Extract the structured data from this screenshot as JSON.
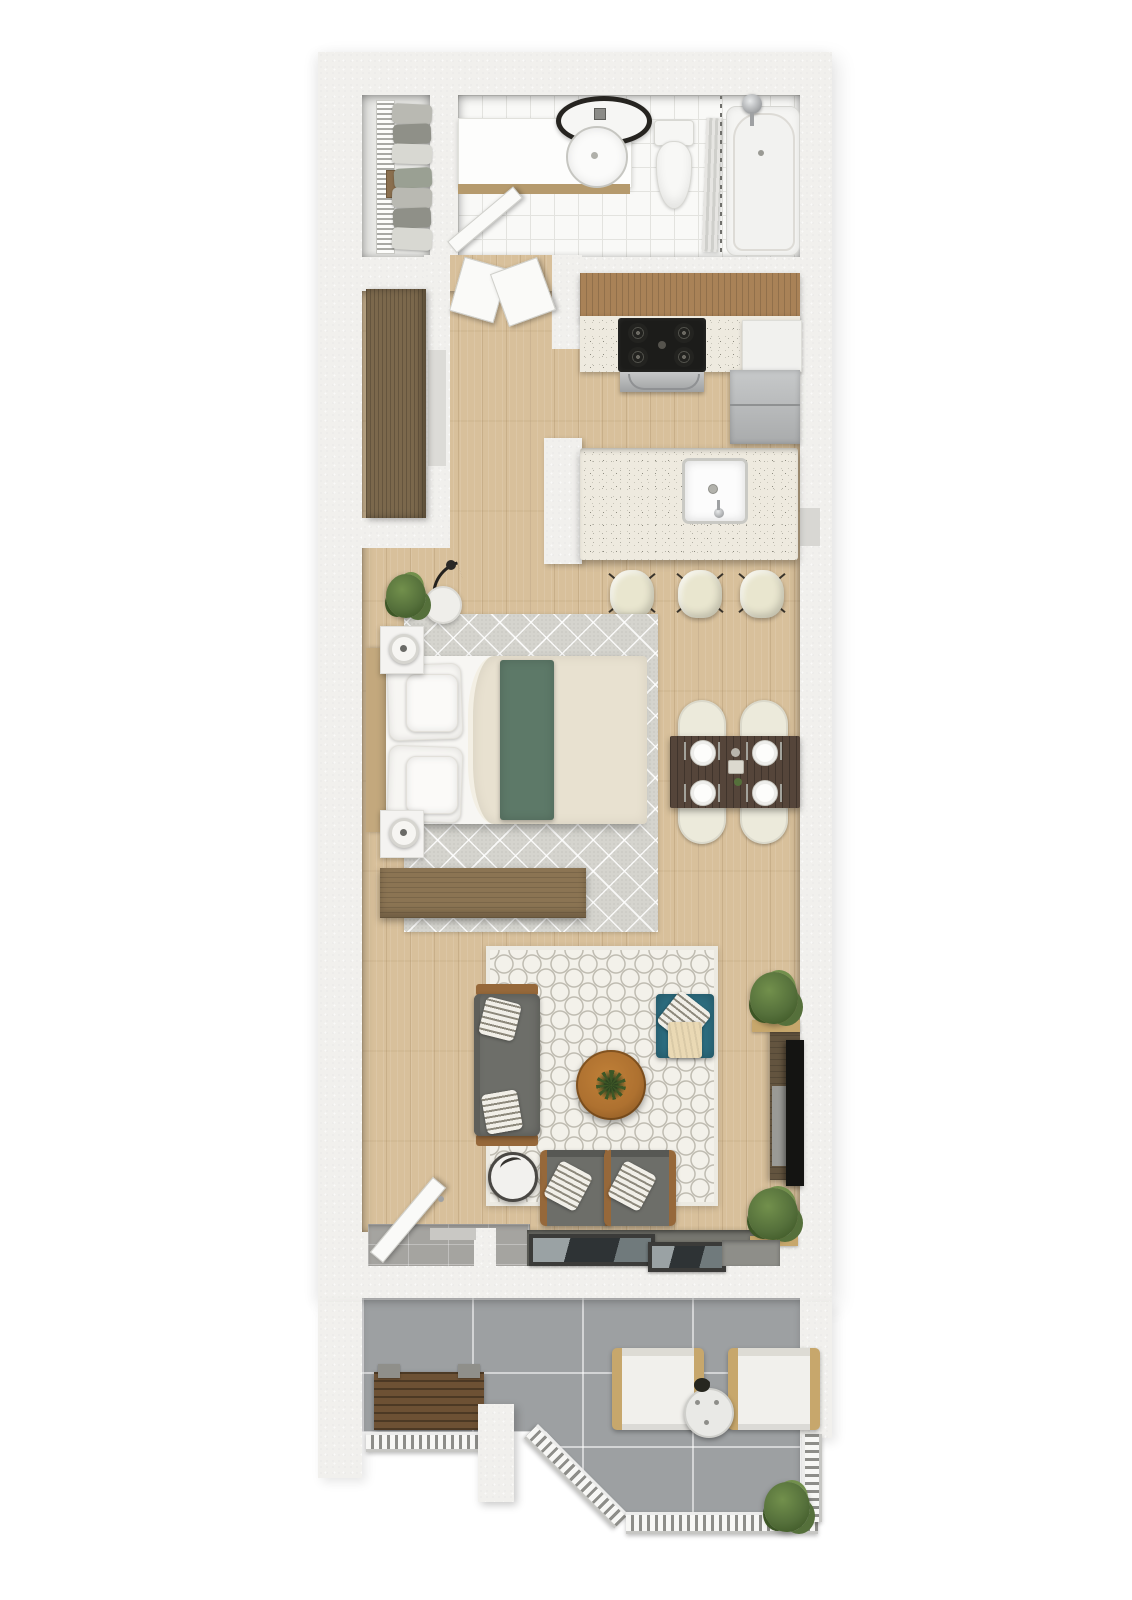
{
  "scene": {
    "type": "3d-floor-plan-render",
    "view": "top-down",
    "description": "Photorealistic top-down 3D rendering of a narrow studio apartment floor plan with closet, bathroom, galley kitchen with island, sleeping area, dining area, living area, tiled entry with sliding glass doors and a lower balcony with railing"
  },
  "palette": {
    "wall": "#f1f0ed",
    "wall_shade": "#d8d7d3",
    "wood_floor": "#d8c09b",
    "wood_line": "#c2a67d",
    "tile_white": "#f9f9f7",
    "tile_line": "#e3e3df",
    "closet_floor": "#e8e8e5",
    "entry_tile": "#a5a4a0",
    "balcony_tile": "#9da0a2",
    "cabinet_wood": "#a98257",
    "counter_base": "#eeeadf",
    "stove": "#1c1c1a",
    "stainless": "#b8babb",
    "wardrobe": "#7b684c",
    "walnut": "#55453a",
    "cream_chair": "#eceadb",
    "stool_cream": "#e9e6cf",
    "rug_gray": "#d5d4ce",
    "rug_white": "#f3f1ea",
    "bed_white": "#f7f6f3",
    "blanket": "#e8e1d0",
    "green": "#5d7968",
    "headboard": "#c3a87d",
    "dresser": "#8b7453",
    "sofa": "#6d6e69",
    "wood_accent": "#96683a",
    "teal": "#2d6e81",
    "table_wood": "#ae7130",
    "console": "#63543f",
    "tv": "#141412",
    "plant": "#55703b",
    "plant_light": "#72904c",
    "plant_dark": "#3d5726",
    "railing_dark": "#8d8d89",
    "bench": "#6d5134",
    "arm_wood": "#c7a76c",
    "door_white": "#fafaf8",
    "frame_dark": "#3b3b39",
    "glass": "#2e3335",
    "stripe_dark": "#8d897c",
    "stripe_light": "#f1efe8",
    "throw_cream": "#ead9b4"
  },
  "rooms": {
    "closet": {
      "name": "walk-in-closet",
      "items": [
        {
          "name": "hanging-clothes-rack"
        },
        {
          "name": "shelf-box"
        }
      ]
    },
    "bathroom": {
      "name": "bathroom",
      "items": [
        {
          "name": "vanity-counter"
        },
        {
          "name": "mirror-vanity-light"
        },
        {
          "name": "round-basin"
        },
        {
          "name": "toilet"
        },
        {
          "name": "shower-curtain"
        },
        {
          "name": "bathtub"
        },
        {
          "name": "bathroom-door"
        }
      ]
    },
    "hall": {
      "name": "entry-hall",
      "items": [
        {
          "name": "wardrobe-cabinet"
        },
        {
          "name": "hall-door-ajar"
        }
      ]
    },
    "kitchen": {
      "name": "kitchen",
      "items": [
        {
          "name": "upper-cabinets"
        },
        {
          "name": "counter"
        },
        {
          "name": "gas-cooktop"
        },
        {
          "name": "oven"
        },
        {
          "name": "refrigerator"
        },
        {
          "name": "kitchen-island"
        },
        {
          "name": "island-sink"
        },
        {
          "name": "bar-stool"
        },
        {
          "name": "bar-stool"
        },
        {
          "name": "bar-stool"
        }
      ]
    },
    "bedroom": {
      "name": "sleeping-area",
      "items": [
        {
          "name": "area-rug"
        },
        {
          "name": "queen-bed"
        },
        {
          "name": "headboard"
        },
        {
          "name": "duvet"
        },
        {
          "name": "green-throw"
        },
        {
          "name": "pillows"
        },
        {
          "name": "nightstand"
        },
        {
          "name": "nightstand"
        },
        {
          "name": "floor-lamp"
        },
        {
          "name": "potted-plant"
        },
        {
          "name": "dresser"
        }
      ]
    },
    "dining": {
      "name": "dining-area",
      "items": [
        {
          "name": "dining-table"
        },
        {
          "name": "dining-chair"
        },
        {
          "name": "dining-chair"
        },
        {
          "name": "dining-chair"
        },
        {
          "name": "dining-chair"
        },
        {
          "name": "place-setting"
        },
        {
          "name": "centerpiece"
        }
      ]
    },
    "living": {
      "name": "living-area",
      "items": [
        {
          "name": "area-rug"
        },
        {
          "name": "sofa"
        },
        {
          "name": "throw-pillow"
        },
        {
          "name": "coffee-table"
        },
        {
          "name": "teal-accent-chair"
        },
        {
          "name": "armchair"
        },
        {
          "name": "armchair"
        },
        {
          "name": "side-table"
        },
        {
          "name": "media-console"
        },
        {
          "name": "television"
        },
        {
          "name": "potted-plant"
        },
        {
          "name": "potted-plant"
        }
      ]
    },
    "entry": {
      "name": "entry",
      "items": [
        {
          "name": "front-door"
        },
        {
          "name": "sliding-glass-doors"
        },
        {
          "name": "tiled-entry"
        }
      ]
    },
    "balcony": {
      "name": "balcony",
      "items": [
        {
          "name": "bench"
        },
        {
          "name": "lounge-chair"
        },
        {
          "name": "lounge-chair"
        },
        {
          "name": "bistro-table"
        },
        {
          "name": "railing"
        },
        {
          "name": "column"
        },
        {
          "name": "potted-plant"
        }
      ]
    }
  }
}
